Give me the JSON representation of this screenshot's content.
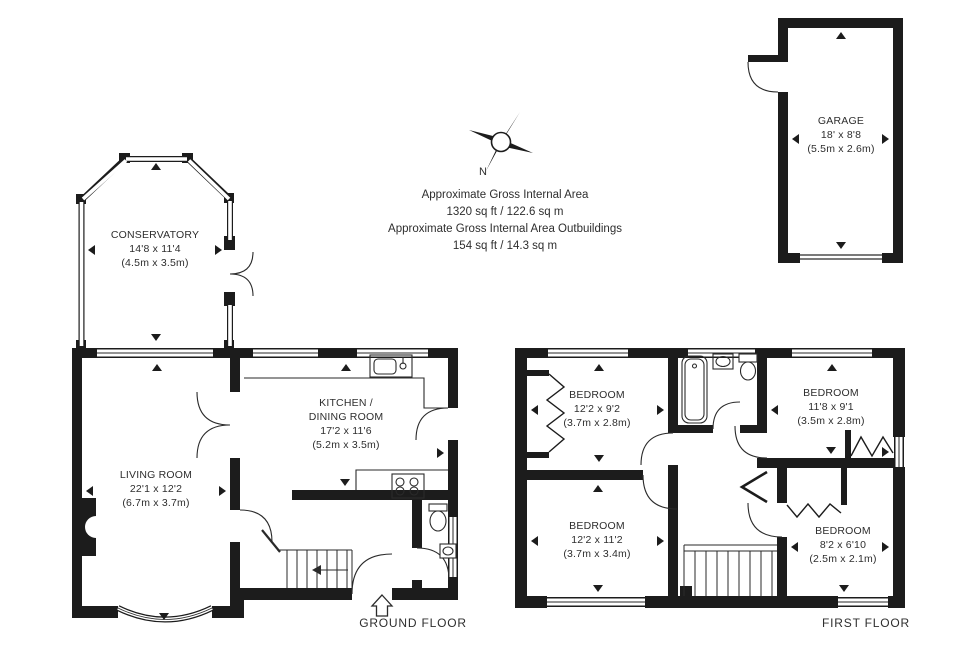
{
  "header": {
    "compass_label": "N",
    "area_line1": "Approximate Gross Internal Area",
    "area_line2": "1320 sq ft / 122.6 sq m",
    "area_line3": "Approximate Gross Internal Area Outbuildings",
    "area_line4": "154 sq ft / 14.3 sq m"
  },
  "floor_labels": {
    "ground": "GROUND FLOOR",
    "first": "FIRST FLOOR"
  },
  "rooms": {
    "conservatory": {
      "name": "CONSERVATORY",
      "imperial": "14'8 x 11'4",
      "metric": "(4.5m x 3.5m)"
    },
    "living_room": {
      "name": "LIVING ROOM",
      "imperial": "22'1 x 12'2",
      "metric": "(6.7m x 3.7m)"
    },
    "kitchen_dining_room": {
      "name_line1": "KITCHEN /",
      "name_line2": "DINING ROOM",
      "imperial": "17'2 x 11'6",
      "metric": "(5.2m x 3.5m)"
    },
    "garage": {
      "name": "GARAGE",
      "imperial": "18' x 8'8",
      "metric": "(5.5m x 2.6m)"
    },
    "bedroom_front_left": {
      "name": "BEDROOM",
      "imperial": "12'2 x 9'2",
      "metric": "(3.7m x 2.8m)"
    },
    "bedroom_front_right": {
      "name": "BEDROOM",
      "imperial": "11'8 x 9'1",
      "metric": "(3.5m x 2.8m)"
    },
    "bedroom_back_left": {
      "name": "BEDROOM",
      "imperial": "12'2 x 11'2",
      "metric": "(3.7m x 3.4m)"
    },
    "bedroom_back_right": {
      "name": "BEDROOM",
      "imperial": "8'2 x 6'10",
      "metric": "(2.5m x 2.1m)"
    }
  },
  "colors": {
    "wall": "#1c1c1c",
    "line": "#2a2a2a",
    "text": "#2e2e2e",
    "background": "#ffffff"
  }
}
